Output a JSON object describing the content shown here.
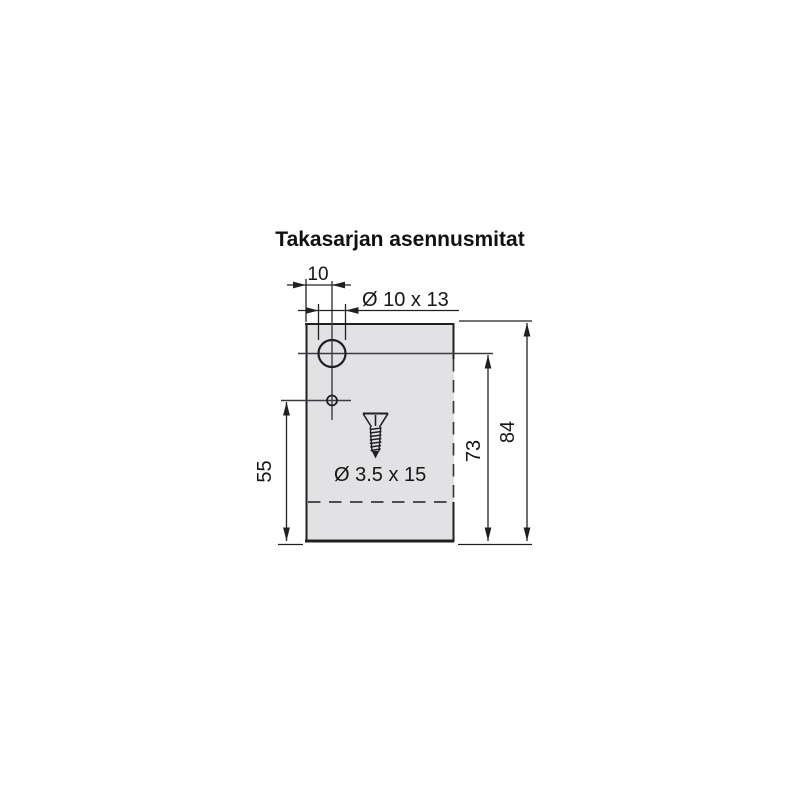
{
  "title": "Takasarjan asennusmitat",
  "plate": {
    "fill_color": "#e2e2e4",
    "hole_fill_color": "#ffffff"
  },
  "dimensions": {
    "edge_to_hole_center": "10",
    "hole_size": "Ø 10 x 13",
    "screw_size": "Ø 3.5 x 15",
    "small_hole_to_bottom": "55",
    "large_hole_to_bottom": "73",
    "total_height": "84"
  },
  "icons": {
    "screw_icon": "countersunk-screw"
  }
}
